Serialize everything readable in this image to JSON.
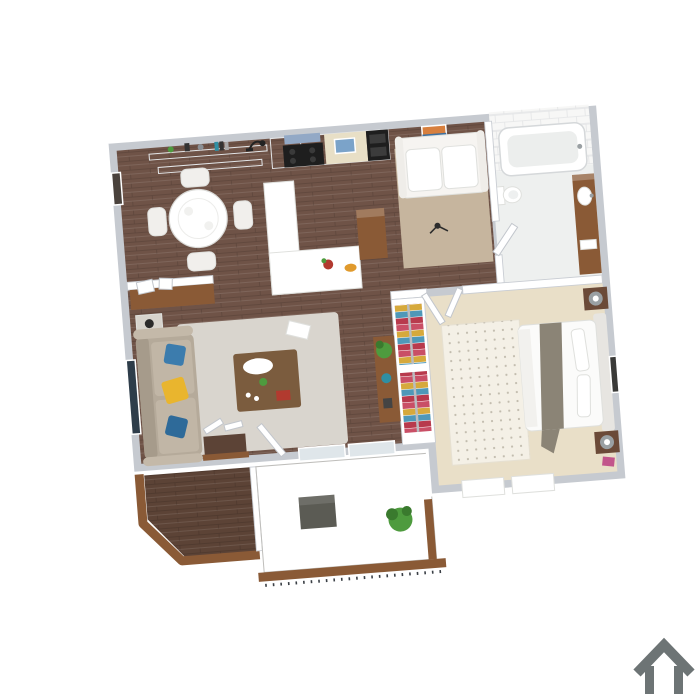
{
  "scene": {
    "description": "3D isometric rendering of a one-bedroom apartment floor plan, viewed from above, tilted slightly, on a plain white background",
    "background": "#ffffff",
    "rotation_deg": -4.5
  },
  "logo": {
    "icon": "house-outline-icon",
    "color": "#6d7475"
  },
  "rooms": [
    {
      "name": "Dining Area",
      "floor": "dark hardwood",
      "items": [
        "round white dining table",
        "four white chairs",
        "two wall shelves with decor",
        "black desk lamp",
        "small framed picture on wall"
      ]
    },
    {
      "name": "Kitchen",
      "floor": "dark hardwood",
      "items": [
        "white upper cabinets",
        "black range with blue vent hood",
        "beige backsplash with blue art",
        "black built-in oven",
        "white peninsula counter",
        "red flower vase",
        "orange fruit bowl",
        "wood bar cabinet"
      ]
    },
    {
      "name": "Den",
      "floor": "hardwood with tan rug",
      "items": [
        "white loveseat",
        "framed sunset art",
        "small dark object on rug"
      ]
    },
    {
      "name": "Bathroom",
      "floor": "light tile",
      "items": [
        "white subway-tiled wall",
        "bathtub",
        "toilet",
        "wood vanity with white sink",
        "towel",
        "door"
      ]
    },
    {
      "name": "Bedroom",
      "floor": "beige carpet",
      "items": [
        "bed with white bedding and gray throw",
        "two dark nightstands with round lamps",
        "patterned cream rug",
        "framed art on wall",
        "two closets with colorful hanging clothes",
        "two windows",
        "double doors"
      ]
    },
    {
      "name": "Living Room",
      "floor": "hardwood with gray rug",
      "items": [
        "beige sofa with blue and yellow pillows",
        "side table with black lamp",
        "large dark framed artwork",
        "wood coffee table with tray, plant and red box",
        "magazine",
        "wood media console with plant and teal bowl",
        "entry console with leaning frames",
        "open entry closet",
        "entry door",
        "sliding glass doors"
      ]
    },
    {
      "name": "Entry Porch",
      "floor": "dark wood deck",
      "items": [
        "L-shaped wood railing"
      ]
    },
    {
      "name": "Patio",
      "floor": "concrete",
      "items": [
        "dark storage cube",
        "green potted plant",
        "wood railing with metal balusters"
      ]
    }
  ],
  "colors": {
    "wall_band": "#c6cad0",
    "wall_white": "#ffffff",
    "wood": "#6f5347",
    "deck": "#5c4336",
    "rail": "#8a5a36",
    "concrete": "#c9c8c4",
    "carpet": "#e9dfc8",
    "bed_rug": "#f4f0e6",
    "living_rug": "#d9d5ce",
    "den_rug": "#c6b59e",
    "sofa": "#b5aa9a",
    "sofa_back": "#a69b8b",
    "cushion": "#c1b6a6",
    "pillow_blue": "#3c7cad",
    "pillow_blue2": "#2e6a99",
    "pillow_yellow": "#e9b52e",
    "coffee_table": "#7b5c3e",
    "side_table": "#d7d3cc",
    "console_wood": "#8a5a36",
    "artwork": "#2e3d4a",
    "picture_dark": "#4a423c",
    "cabinet": "#f3f4f4",
    "hood": "#93a9c6",
    "stove": "#1e1e1e",
    "backsplash": "#e8dfc6",
    "art_blue": "#7ba3c9",
    "counter": "#ffffff",
    "bath_floor": "#eef0ef",
    "tile": "#f7f7f6",
    "vanity": "#8a5a36",
    "bed": "#fbfbfa",
    "headboard": "#e7e5e1",
    "blanket": "#8b8476",
    "nightstand": "#6b4a38",
    "lamp": "#9aa0a3",
    "clothes_a": "#c94f66",
    "clothes_b": "#d6a93c",
    "clothes_c": "#4f98b8",
    "clothes_d": "#b83a4d",
    "rod": "#b9bcc0",
    "plant": "#4e9b3e",
    "plant_dark": "#3a7a2e",
    "cube": "#5b5b54",
    "red_box": "#b23a2f",
    "teal": "#2f8fa3",
    "chair": "#f1efec",
    "table_white": "#ffffff",
    "glass": "#dfe6ea",
    "pink": "#c2558b",
    "loveseat": "#f6f4f1"
  }
}
